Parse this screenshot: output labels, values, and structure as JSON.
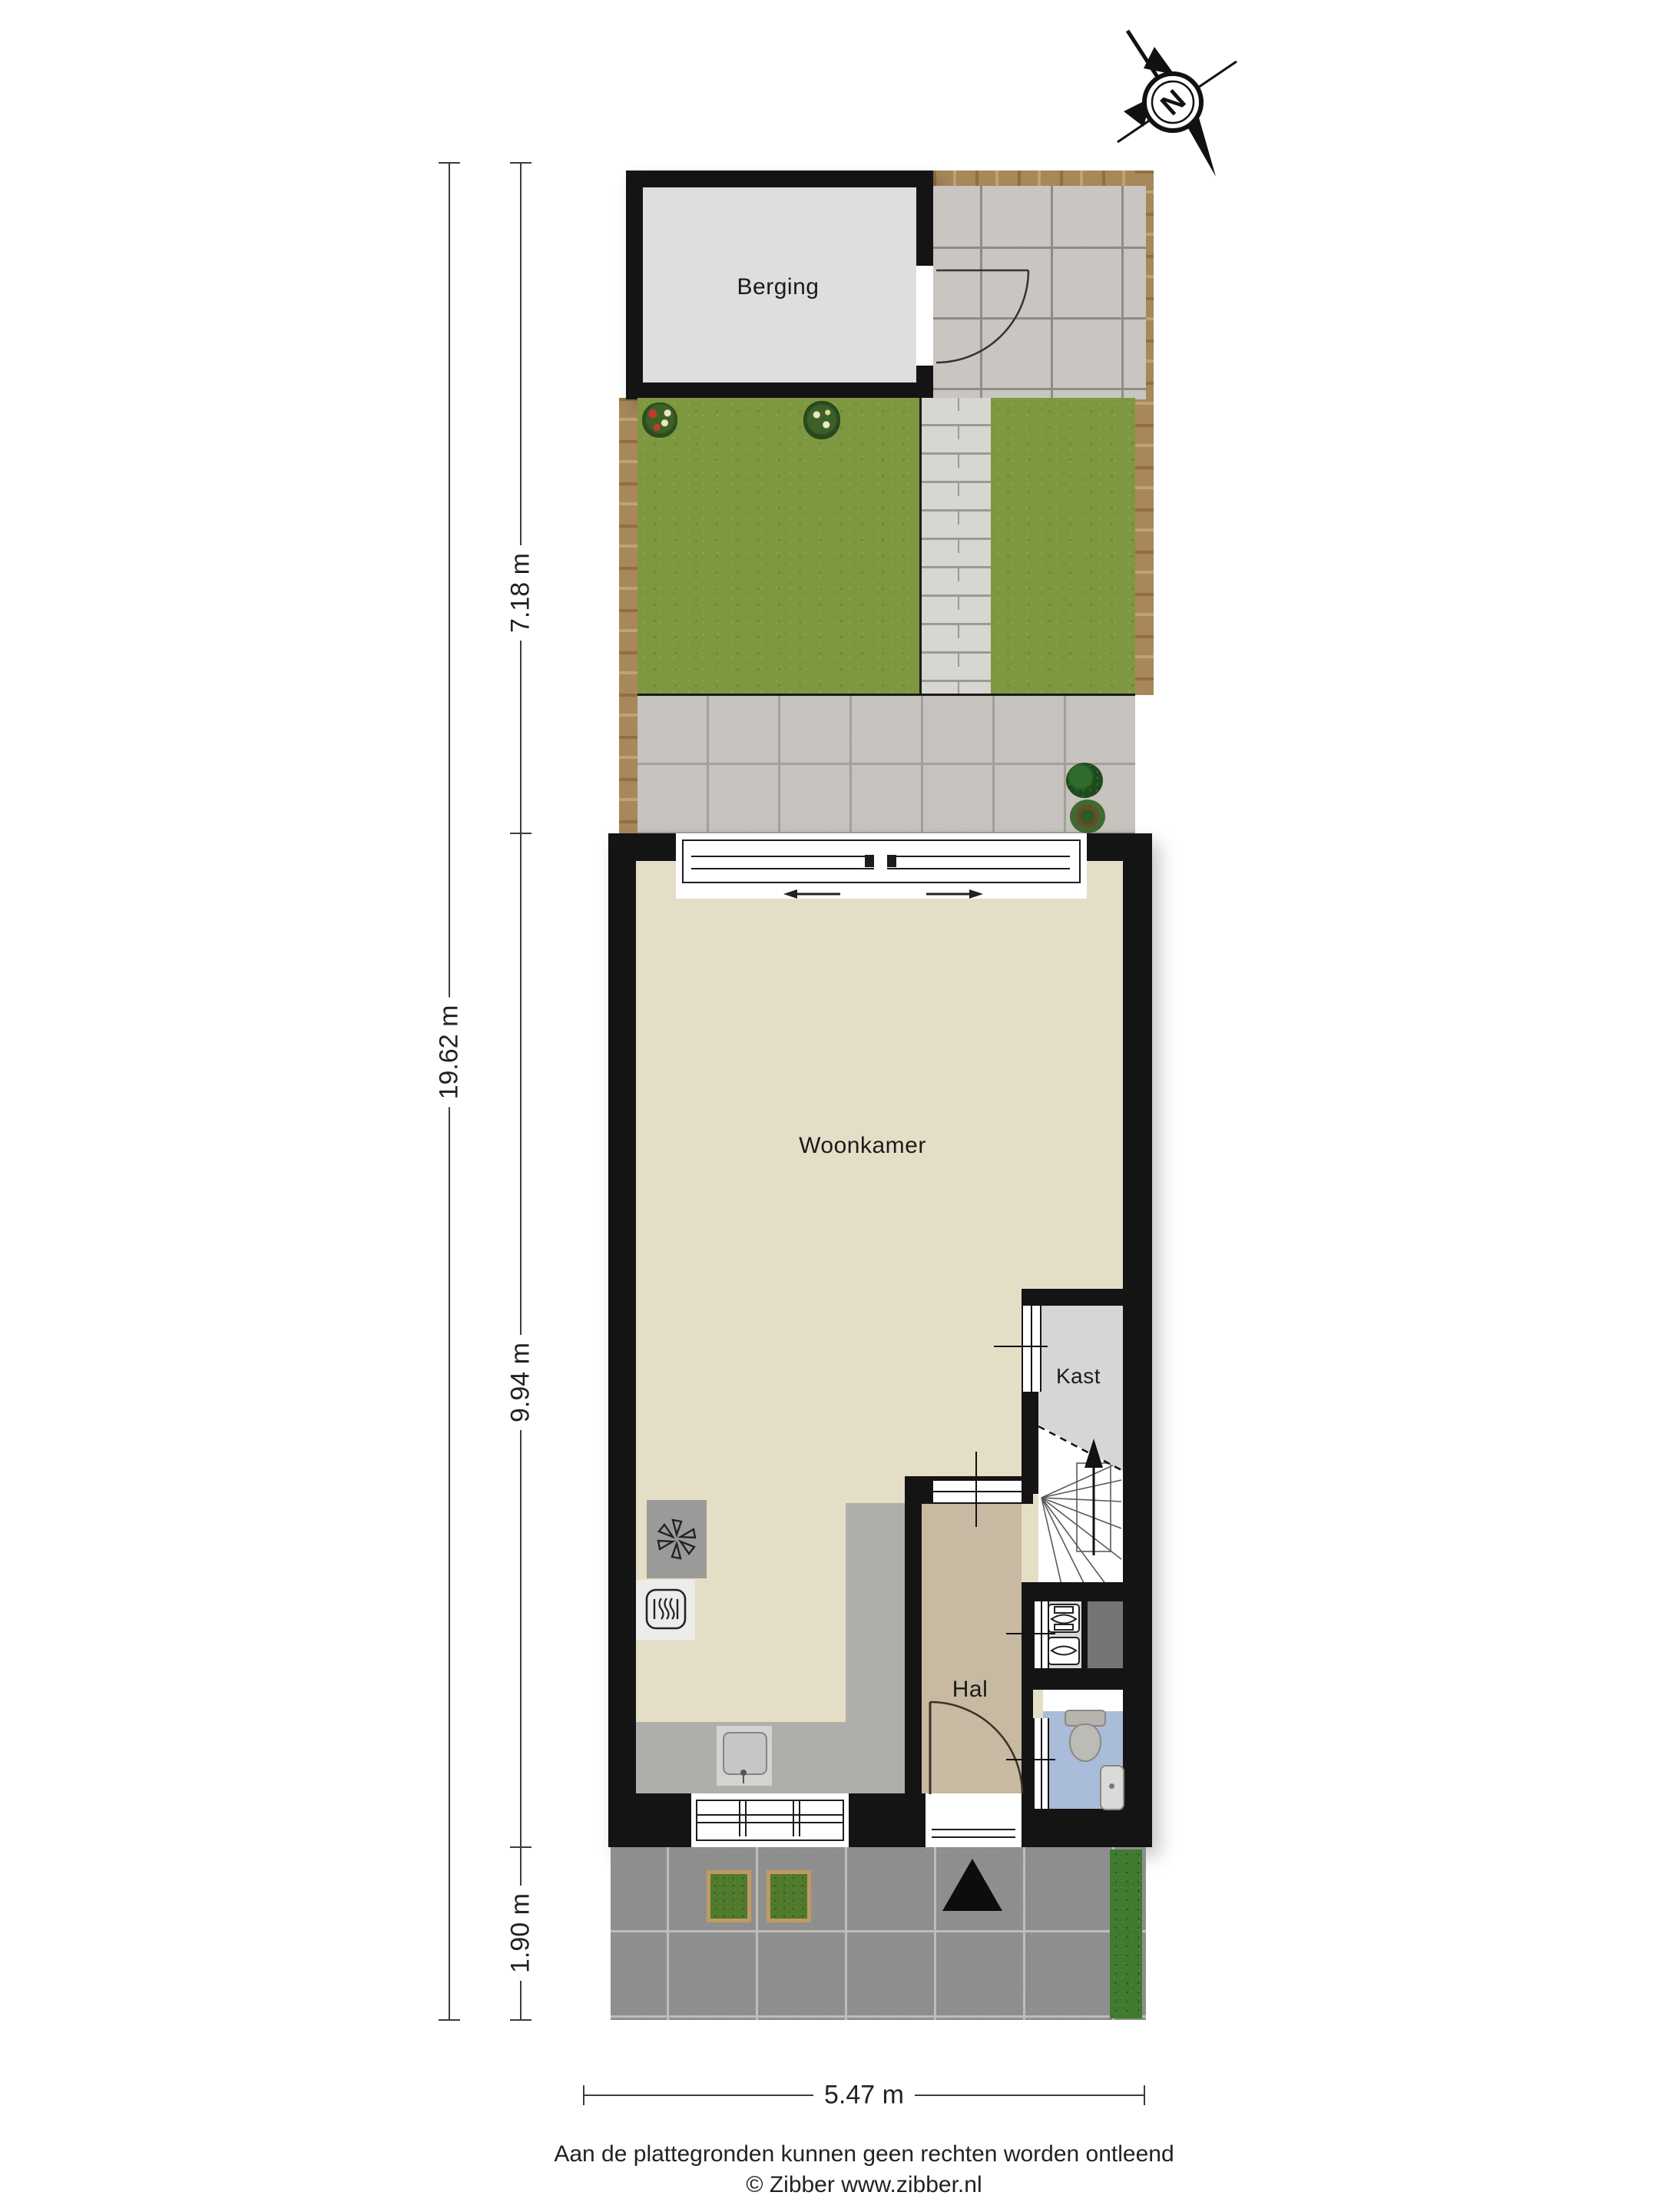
{
  "compass": {
    "letter": "N"
  },
  "rooms": {
    "berging": "Berging",
    "woonkamer": "Woonkamer",
    "kast": "Kast",
    "hal": "Hal"
  },
  "dimensions": {
    "total_depth": "19.62 m",
    "garden_depth": "7.18 m",
    "house_depth": "9.94 m",
    "front_depth": "1.90 m",
    "width": "5.47 m"
  },
  "footer": {
    "disclaimer": "Aan de plattegronden kunnen geen rechten worden ontleend",
    "credit": "© Zibber www.zibber.nl"
  },
  "colors": {
    "wall": "#141414",
    "living_floor": "#E5DEC6",
    "hall_floor": "#C8B9A3",
    "closet_floor": "#D6D6D4",
    "shed_floor": "#DEDEDE",
    "kitchen_floor": "#B0AEAB",
    "toilet_floor": "#A9BCD9",
    "grass": "#7E9840",
    "fence": "#A8875B",
    "terrace_tile": "#C6C3BE",
    "sidewalk": "#8E8E8E",
    "hedge": "#3F7A2F"
  }
}
